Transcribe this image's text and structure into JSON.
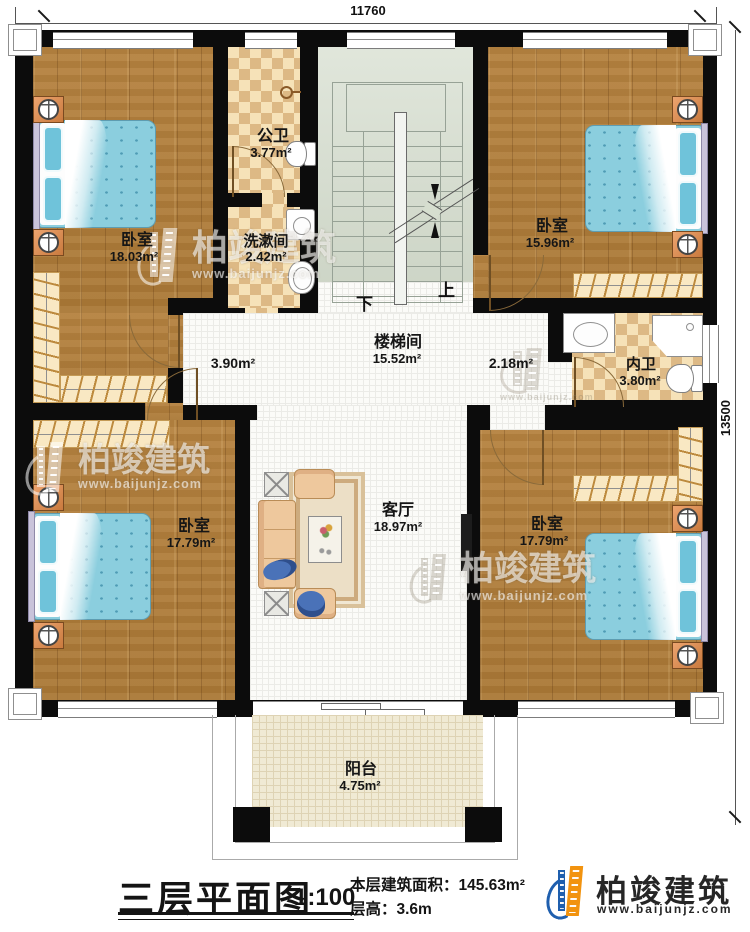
{
  "dimensions": {
    "top": "11760",
    "right": "13500"
  },
  "rooms": {
    "bedroom_tl": {
      "name": "卧室",
      "area": "18.03m²"
    },
    "public_bath": {
      "name": "公卫",
      "area": "3.77m²"
    },
    "washroom": {
      "name": "洗漱间",
      "area": "2.42m²"
    },
    "bedroom_tr": {
      "name": "卧室",
      "area": "15.96m²"
    },
    "stairwell": {
      "name": "楼梯间",
      "area": "15.52m²"
    },
    "hall_left": {
      "area": "3.90m²"
    },
    "hall_right": {
      "area": "2.18m²"
    },
    "ensuite": {
      "name": "内卫",
      "area": "3.80m²"
    },
    "living": {
      "name": "客厅",
      "area": "18.97m²"
    },
    "bedroom_bl": {
      "name": "卧室",
      "area": "17.79m²"
    },
    "bedroom_br": {
      "name": "卧室",
      "area": "17.79m²"
    },
    "balcony": {
      "name": "阳台",
      "area": "4.75m²"
    }
  },
  "stairs": {
    "down": "下",
    "up": "上"
  },
  "title_block": {
    "title": "三层平面图",
    "scale": "1:100",
    "floor_area": "本层建筑面积：145.63m²",
    "floor_height": "层高：3.6m"
  },
  "brand": {
    "name": "柏竣建筑",
    "url": "www.baijunjz.com"
  },
  "watermark": {
    "name": "柏竣建筑",
    "url": "www.baijunjz.com"
  },
  "colors": {
    "wall": "#0c0c0c",
    "wood_floor": "#b5803d",
    "bath_tile": "#ddb985",
    "stair": "#d6decf",
    "bed": "#8bcede",
    "logo_blue": "#1f5fae",
    "logo_orange": "#f2930f"
  }
}
